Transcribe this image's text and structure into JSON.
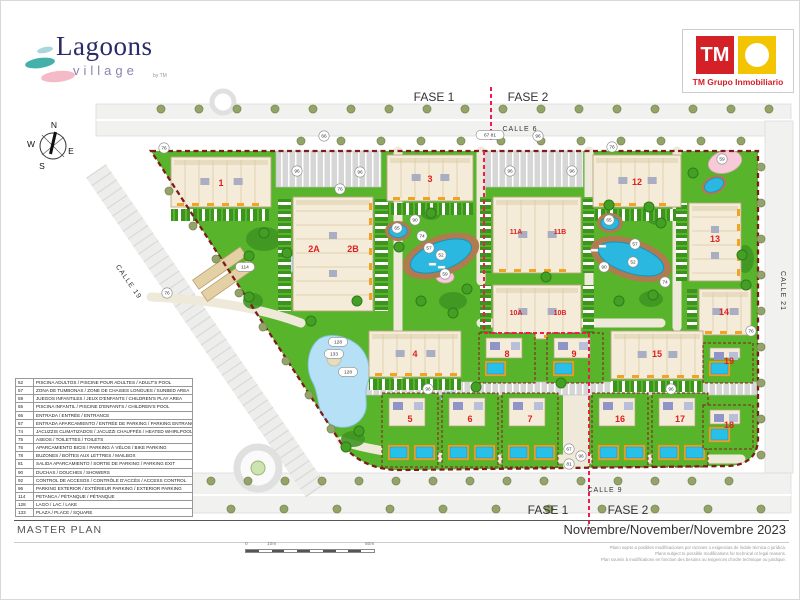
{
  "header": {
    "logo": {
      "title": "Lagoons",
      "subtitle": "village",
      "byline": "by TM"
    },
    "tm_logo": {
      "monogram": "TM",
      "company": "TM Grupo Inmobiliario",
      "red": "#d42027",
      "yellow": "#f2c500"
    }
  },
  "map": {
    "phases": {
      "top_left": "FASE 1",
      "top_right": "FASE 2",
      "bottom_left": "FASE 1",
      "bottom_right": "FASE 2"
    },
    "streets": {
      "top": "CALLE 6",
      "bottom": "CALLE 9",
      "left": "CALLE 19",
      "right": "CALLE 21"
    },
    "compass": {
      "n": "N",
      "s": "S",
      "e": "E",
      "w": "W"
    },
    "colors": {
      "lawn": "#58b42a",
      "pool": "#2ab8e0",
      "boundary": "#7e1c1c",
      "phase_line": "#f01a4e",
      "building": "#f4ebd8",
      "label_red": "#e02020",
      "lake": "#b5e0f5"
    },
    "building_labels": [
      {
        "label": "1",
        "x": 220,
        "y": 185
      },
      {
        "label": "2A",
        "x": 313,
        "y": 251
      },
      {
        "label": "2B",
        "x": 352,
        "y": 251
      },
      {
        "label": "3",
        "x": 429,
        "y": 181
      },
      {
        "label": "4",
        "x": 414,
        "y": 356
      },
      {
        "label": "5",
        "x": 409,
        "y": 421
      },
      {
        "label": "6",
        "x": 469,
        "y": 421
      },
      {
        "label": "7",
        "x": 529,
        "y": 421
      },
      {
        "label": "8",
        "x": 506,
        "y": 356
      },
      {
        "label": "9",
        "x": 573,
        "y": 356
      },
      {
        "label": "10A",
        "x": 515,
        "y": 314
      },
      {
        "label": "10B",
        "x": 559,
        "y": 314
      },
      {
        "label": "11A",
        "x": 515,
        "y": 233
      },
      {
        "label": "11B",
        "x": 559,
        "y": 233
      },
      {
        "label": "12",
        "x": 636,
        "y": 184
      },
      {
        "label": "13",
        "x": 714,
        "y": 241
      },
      {
        "label": "14",
        "x": 723,
        "y": 314
      },
      {
        "label": "15",
        "x": 656,
        "y": 356
      },
      {
        "label": "16",
        "x": 619,
        "y": 421
      },
      {
        "label": "17",
        "x": 679,
        "y": 421
      },
      {
        "label": "18",
        "x": 728,
        "y": 427
      },
      {
        "label": "19",
        "x": 728,
        "y": 363
      }
    ],
    "markers": [
      {
        "label": "76",
        "x": 163,
        "y": 147
      },
      {
        "label": "76",
        "x": 339,
        "y": 188
      },
      {
        "label": "76",
        "x": 611,
        "y": 146
      },
      {
        "label": "76",
        "x": 750,
        "y": 330
      },
      {
        "label": "76",
        "x": 166,
        "y": 292
      },
      {
        "label": "66",
        "x": 323,
        "y": 135
      },
      {
        "label": "96",
        "x": 537,
        "y": 135
      },
      {
        "label": "67 81",
        "x": 489,
        "y": 134
      },
      {
        "label": "96",
        "x": 296,
        "y": 170
      },
      {
        "label": "96",
        "x": 359,
        "y": 171
      },
      {
        "label": "96",
        "x": 509,
        "y": 170
      },
      {
        "label": "96",
        "x": 571,
        "y": 170
      },
      {
        "label": "96",
        "x": 427,
        "y": 388
      },
      {
        "label": "96",
        "x": 670,
        "y": 388
      },
      {
        "label": "96",
        "x": 580,
        "y": 455
      },
      {
        "label": "67",
        "x": 568,
        "y": 448
      },
      {
        "label": "81",
        "x": 568,
        "y": 463
      },
      {
        "label": "65",
        "x": 396,
        "y": 227
      },
      {
        "label": "65",
        "x": 608,
        "y": 219
      },
      {
        "label": "57",
        "x": 428,
        "y": 247
      },
      {
        "label": "57",
        "x": 634,
        "y": 243
      },
      {
        "label": "52",
        "x": 440,
        "y": 254
      },
      {
        "label": "52",
        "x": 632,
        "y": 261
      },
      {
        "label": "74",
        "x": 421,
        "y": 235
      },
      {
        "label": "74",
        "x": 664,
        "y": 281
      },
      {
        "label": "59",
        "x": 444,
        "y": 273
      },
      {
        "label": "59",
        "x": 721,
        "y": 158
      },
      {
        "label": "90",
        "x": 414,
        "y": 219
      },
      {
        "label": "90",
        "x": 603,
        "y": 266
      },
      {
        "label": "114",
        "x": 244,
        "y": 266
      },
      {
        "label": "128",
        "x": 337,
        "y": 341
      },
      {
        "label": "133",
        "x": 333,
        "y": 353
      },
      {
        "label": "128",
        "x": 347,
        "y": 371
      }
    ]
  },
  "legend": {
    "rows": [
      {
        "num": "52",
        "desc": "PISCINA ADULTOS / PISCINE POUR ADULTES / ADULT'S POOL"
      },
      {
        "num": "57",
        "desc": "ZONA DE TUMBONAS / ZONE DE CHAISES LONGUES / SUNBED AREA"
      },
      {
        "num": "59",
        "desc": "JUEGOS INFANTILES / JEUX D'ENFANTS / CHILDREN'S PLAY AREA"
      },
      {
        "num": "65",
        "desc": "PISCINA INFANTIL / PISCINE D'ENFANTS / CHILDREN'S POOL"
      },
      {
        "num": "66",
        "desc": "ENTRADA / ENTRÉE / ENTRANCE"
      },
      {
        "num": "67",
        "desc": "ENTRADA APARCAMIENTO / ENTRÉE DE PARKING / PARKING ENTRANCE"
      },
      {
        "num": "74",
        "desc": "JACUZZIS CLIMATIZADOS / JACUZZI CHAUFFÉS / HEATED WHIRLPOOLS"
      },
      {
        "num": "75",
        "desc": "ASEOS / TOILETTES / TOILETS"
      },
      {
        "num": "76",
        "desc": "APARCAMIENTO BICIS / PARKING À VÉLOS / BIKE PARKING"
      },
      {
        "num": "78",
        "desc": "BUZONES / BOÎTES AUX LETTRES / MAILBOX"
      },
      {
        "num": "81",
        "desc": "SALIDA APARCAMIENTO / SORTIE DE PARKING / PARKING EXIT"
      },
      {
        "num": "90",
        "desc": "DUCHAS / DOUCHES / SHOWERS"
      },
      {
        "num": "92",
        "desc": "CONTROL DE ACCESOS / CONTRÔLE D'ACCÈS / ACCESS CONTROL"
      },
      {
        "num": "96",
        "desc": "PARKING EXTERIOR / EXTÉRIEUR PARKING / EXTERIOR PARKING"
      },
      {
        "num": "114",
        "desc": "PETANCA / PÉTANQUE / PÉTANQUE"
      },
      {
        "num": "128",
        "desc": "LAGO / LAC / LAKE"
      },
      {
        "num": "133",
        "desc": "PLAZA / PLACE / SQUARE"
      }
    ]
  },
  "footer": {
    "title": "MASTER PLAN",
    "date": "Noviembre/November/Novembre 2023",
    "scale": {
      "zero": "0",
      "ten": "10m",
      "fifty": "50m"
    },
    "disclaimer": [
      "Plano sujeto a posibles modificaciones por razones o exigencias de índole técnica o jurídica.",
      "Plans subject to possible modifications for technical or legal reasons.",
      "Plan soumis à modifications en fonction des besoins ou exigences d'ordre technique ou juridique."
    ]
  }
}
